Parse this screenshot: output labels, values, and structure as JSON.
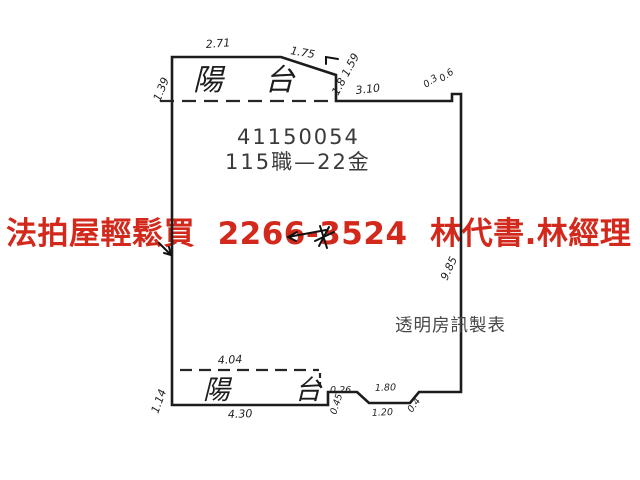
{
  "watermark": {
    "text": "法拍屋輕鬆買  2266-3524  林代書.林經理",
    "color": "#d2291c"
  },
  "plan": {
    "case_number": "41150054",
    "case_label": "115職—22金",
    "maker": "透明房訊製表",
    "balcony_top": "陽 台",
    "balcony_bottom": "陽 台",
    "dims": {
      "top_width": "2.71",
      "top_slope": "1.75",
      "left_top": "1.39",
      "slope_right": "1.8 1.59",
      "top_right_width": "3.10",
      "corner_step_a": "0.3",
      "corner_step_b": "0.6",
      "right_height": "9.85",
      "balcony_bottom_inner_width": "4.04",
      "balcony_bottom_width": "4.30",
      "left_bottom": "1.14",
      "step_width": "0.26",
      "step_height": "0.45",
      "notch_top": "1.80",
      "notch_bottom": "1.20",
      "notch_side": "0.4"
    }
  }
}
